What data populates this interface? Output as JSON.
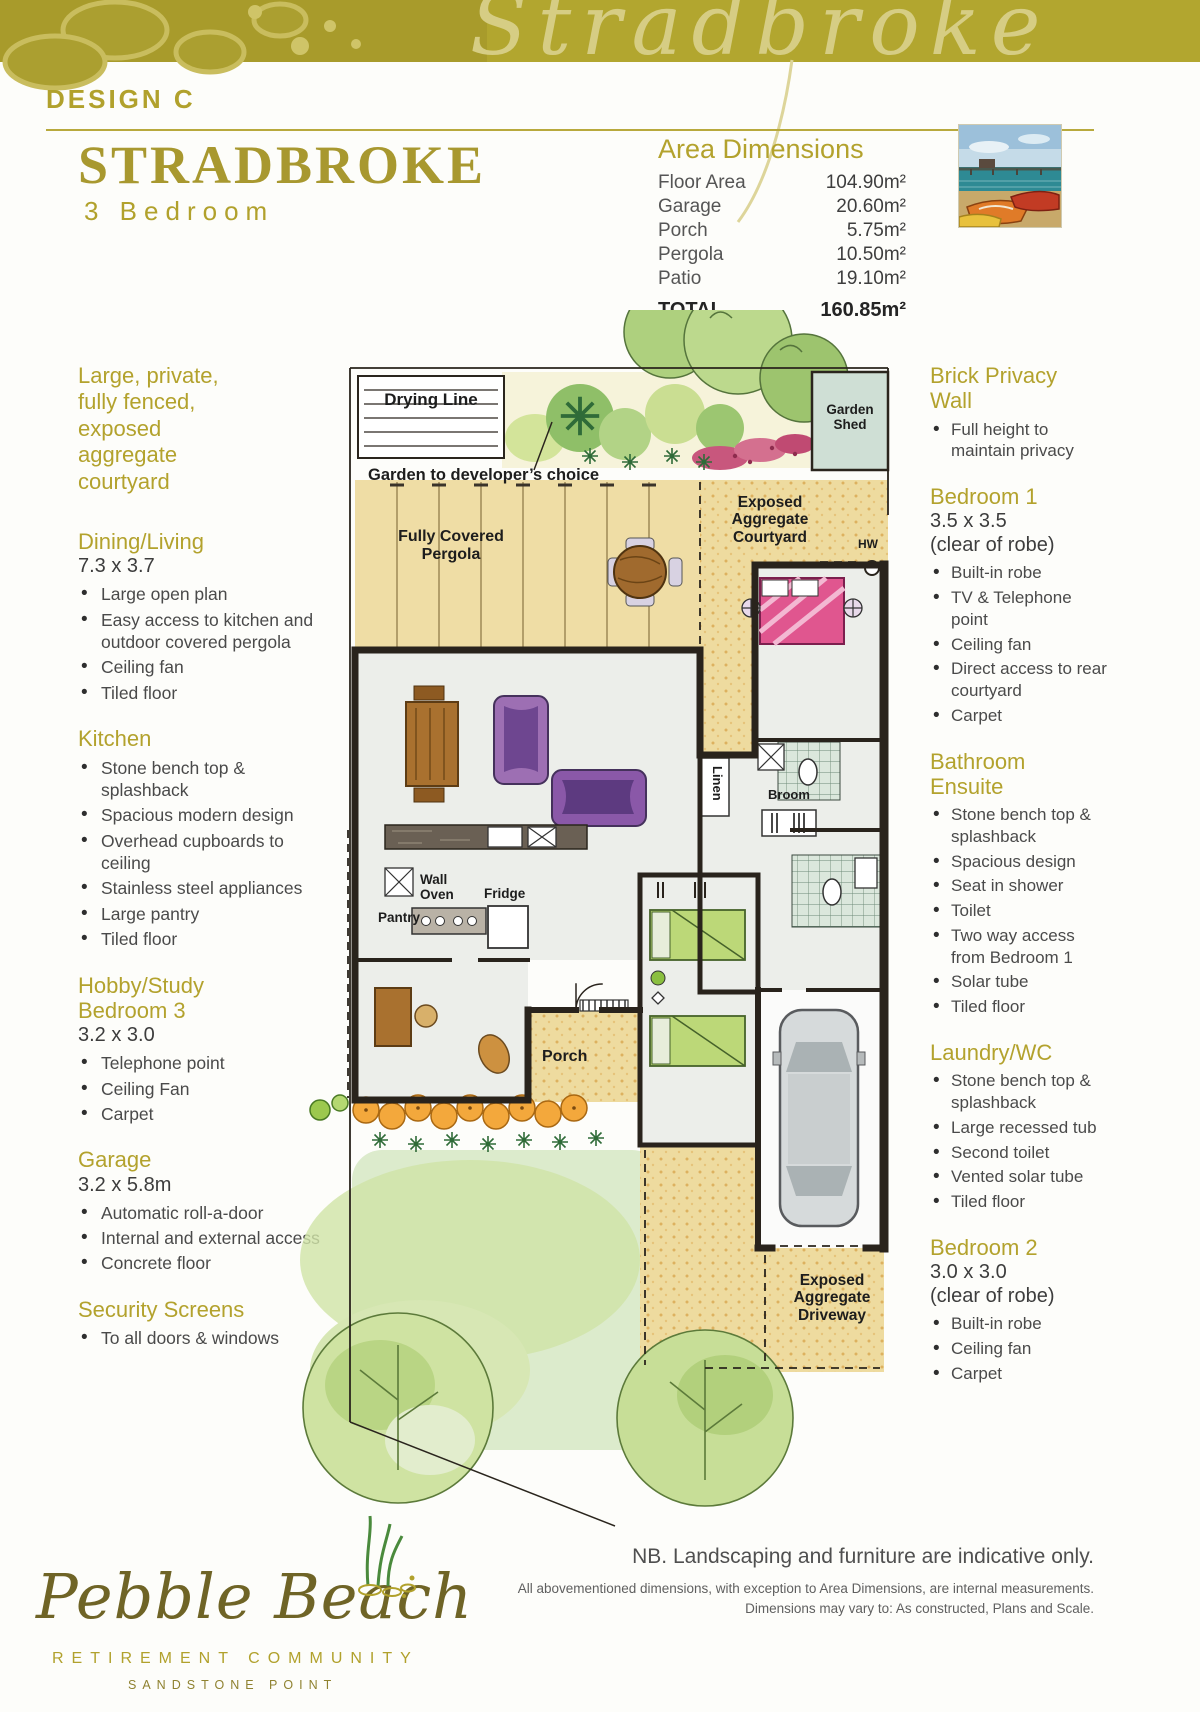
{
  "banner": {
    "script_title": "Stradbroke"
  },
  "header": {
    "design_label": "DESIGN C",
    "title": "STRADBROKE",
    "subtitle": "3 Bedroom"
  },
  "area_dimensions": {
    "title": "Area Dimensions",
    "rows": [
      {
        "label": "Floor Area",
        "value": "104.90m²"
      },
      {
        "label": "Garage",
        "value": "20.60m²"
      },
      {
        "label": "Porch",
        "value": "5.75m²"
      },
      {
        "label": "Pergola",
        "value": "10.50m²"
      },
      {
        "label": "Patio",
        "value": "19.10m²"
      }
    ],
    "total_label": "TOTAL",
    "total_value": "160.85m²"
  },
  "left_column": {
    "intro": "Large, private, fully fenced, exposed aggregate courtyard",
    "sections": [
      {
        "heading": "Dining/Living",
        "dimension": "7.3 x 3.7",
        "bullets": [
          "Large open plan",
          "Easy access to kitchen and outdoor covered pergola",
          "Ceiling fan",
          "Tiled floor"
        ]
      },
      {
        "heading": "Kitchen",
        "dimension": "",
        "bullets": [
          "Stone bench top & splashback",
          "Spacious modern design",
          "Overhead cupboards to ceiling",
          "Stainless steel appliances",
          "Large pantry",
          "Tiled floor"
        ]
      },
      {
        "heading": "Hobby/Study Bedroom 3",
        "dimension": "3.2 x 3.0",
        "bullets": [
          "Telephone point",
          "Ceiling Fan",
          "Carpet"
        ]
      },
      {
        "heading": "Garage",
        "dimension": "3.2 x 5.8m",
        "bullets": [
          "Automatic roll-a-door",
          "Internal and external access",
          "Concrete floor"
        ]
      },
      {
        "heading": "Security Screens",
        "dimension": "",
        "bullets": [
          "To all doors & windows"
        ]
      }
    ]
  },
  "right_column": {
    "sections": [
      {
        "heading": "Brick Privacy Wall",
        "dimension": "",
        "note": "",
        "bullets": [
          "Full height to maintain privacy"
        ]
      },
      {
        "heading": "Bedroom 1",
        "dimension": "3.5 x 3.5",
        "note": "(clear of robe)",
        "bullets": [
          "Built-in robe",
          "TV & Telephone point",
          "Ceiling fan",
          "Direct access to rear courtyard",
          "Carpet"
        ]
      },
      {
        "heading": "Bathroom Ensuite",
        "dimension": "",
        "note": "",
        "bullets": [
          "Stone bench top & splashback",
          "Spacious design",
          "Seat in shower",
          "Toilet",
          "Two way access from Bedroom 1",
          "Solar tube",
          "Tiled floor"
        ]
      },
      {
        "heading": "Laundry/WC",
        "dimension": "",
        "note": "",
        "bullets": [
          "Stone bench top & splashback",
          "Large recessed tub",
          "Second toilet",
          "Vented solar tube",
          "Tiled floor"
        ]
      },
      {
        "heading": "Bedroom 2",
        "dimension": "3.0 x 3.0",
        "note": "(clear of robe)",
        "bullets": [
          "Built-in robe",
          "Ceiling fan",
          "Carpet"
        ]
      }
    ]
  },
  "plan": {
    "labels": {
      "drying_line": "Drying Line",
      "garden_note": "Garden to developer’s choice",
      "garden_shed": "Garden Shed",
      "pergola": "Fully Covered Pergola",
      "courtyard": "Exposed Aggregate Courtyard",
      "hw": "HW",
      "linen": "Linen",
      "broom": "Broom",
      "wall_oven": "Wall Oven",
      "fridge": "Fridge",
      "pantry": "Pantry",
      "porch": "Porch",
      "driveway": "Exposed Aggregate Driveway"
    }
  },
  "footer": {
    "logo_script": "Pebble Beach",
    "logo_line1": "RETIREMENT COMMUNITY",
    "logo_line2": "SANDSTONE POINT",
    "nb": "NB. Landscaping and furniture are indicative only.",
    "disclaimer1": "All abovementioned dimensions, with exception to Area Dimensions, are internal measurements.",
    "disclaimer2": "Dimensions may vary to: As constructed, Plans and Scale."
  },
  "colors": {
    "accent_gold": "#b3a22d",
    "banner_olive": "#ada12e",
    "text_gray": "#4f4f4f",
    "plan_tan": "#eeda9e",
    "lawn_green": "#d9e8bc",
    "wall_black": "#29231c"
  }
}
